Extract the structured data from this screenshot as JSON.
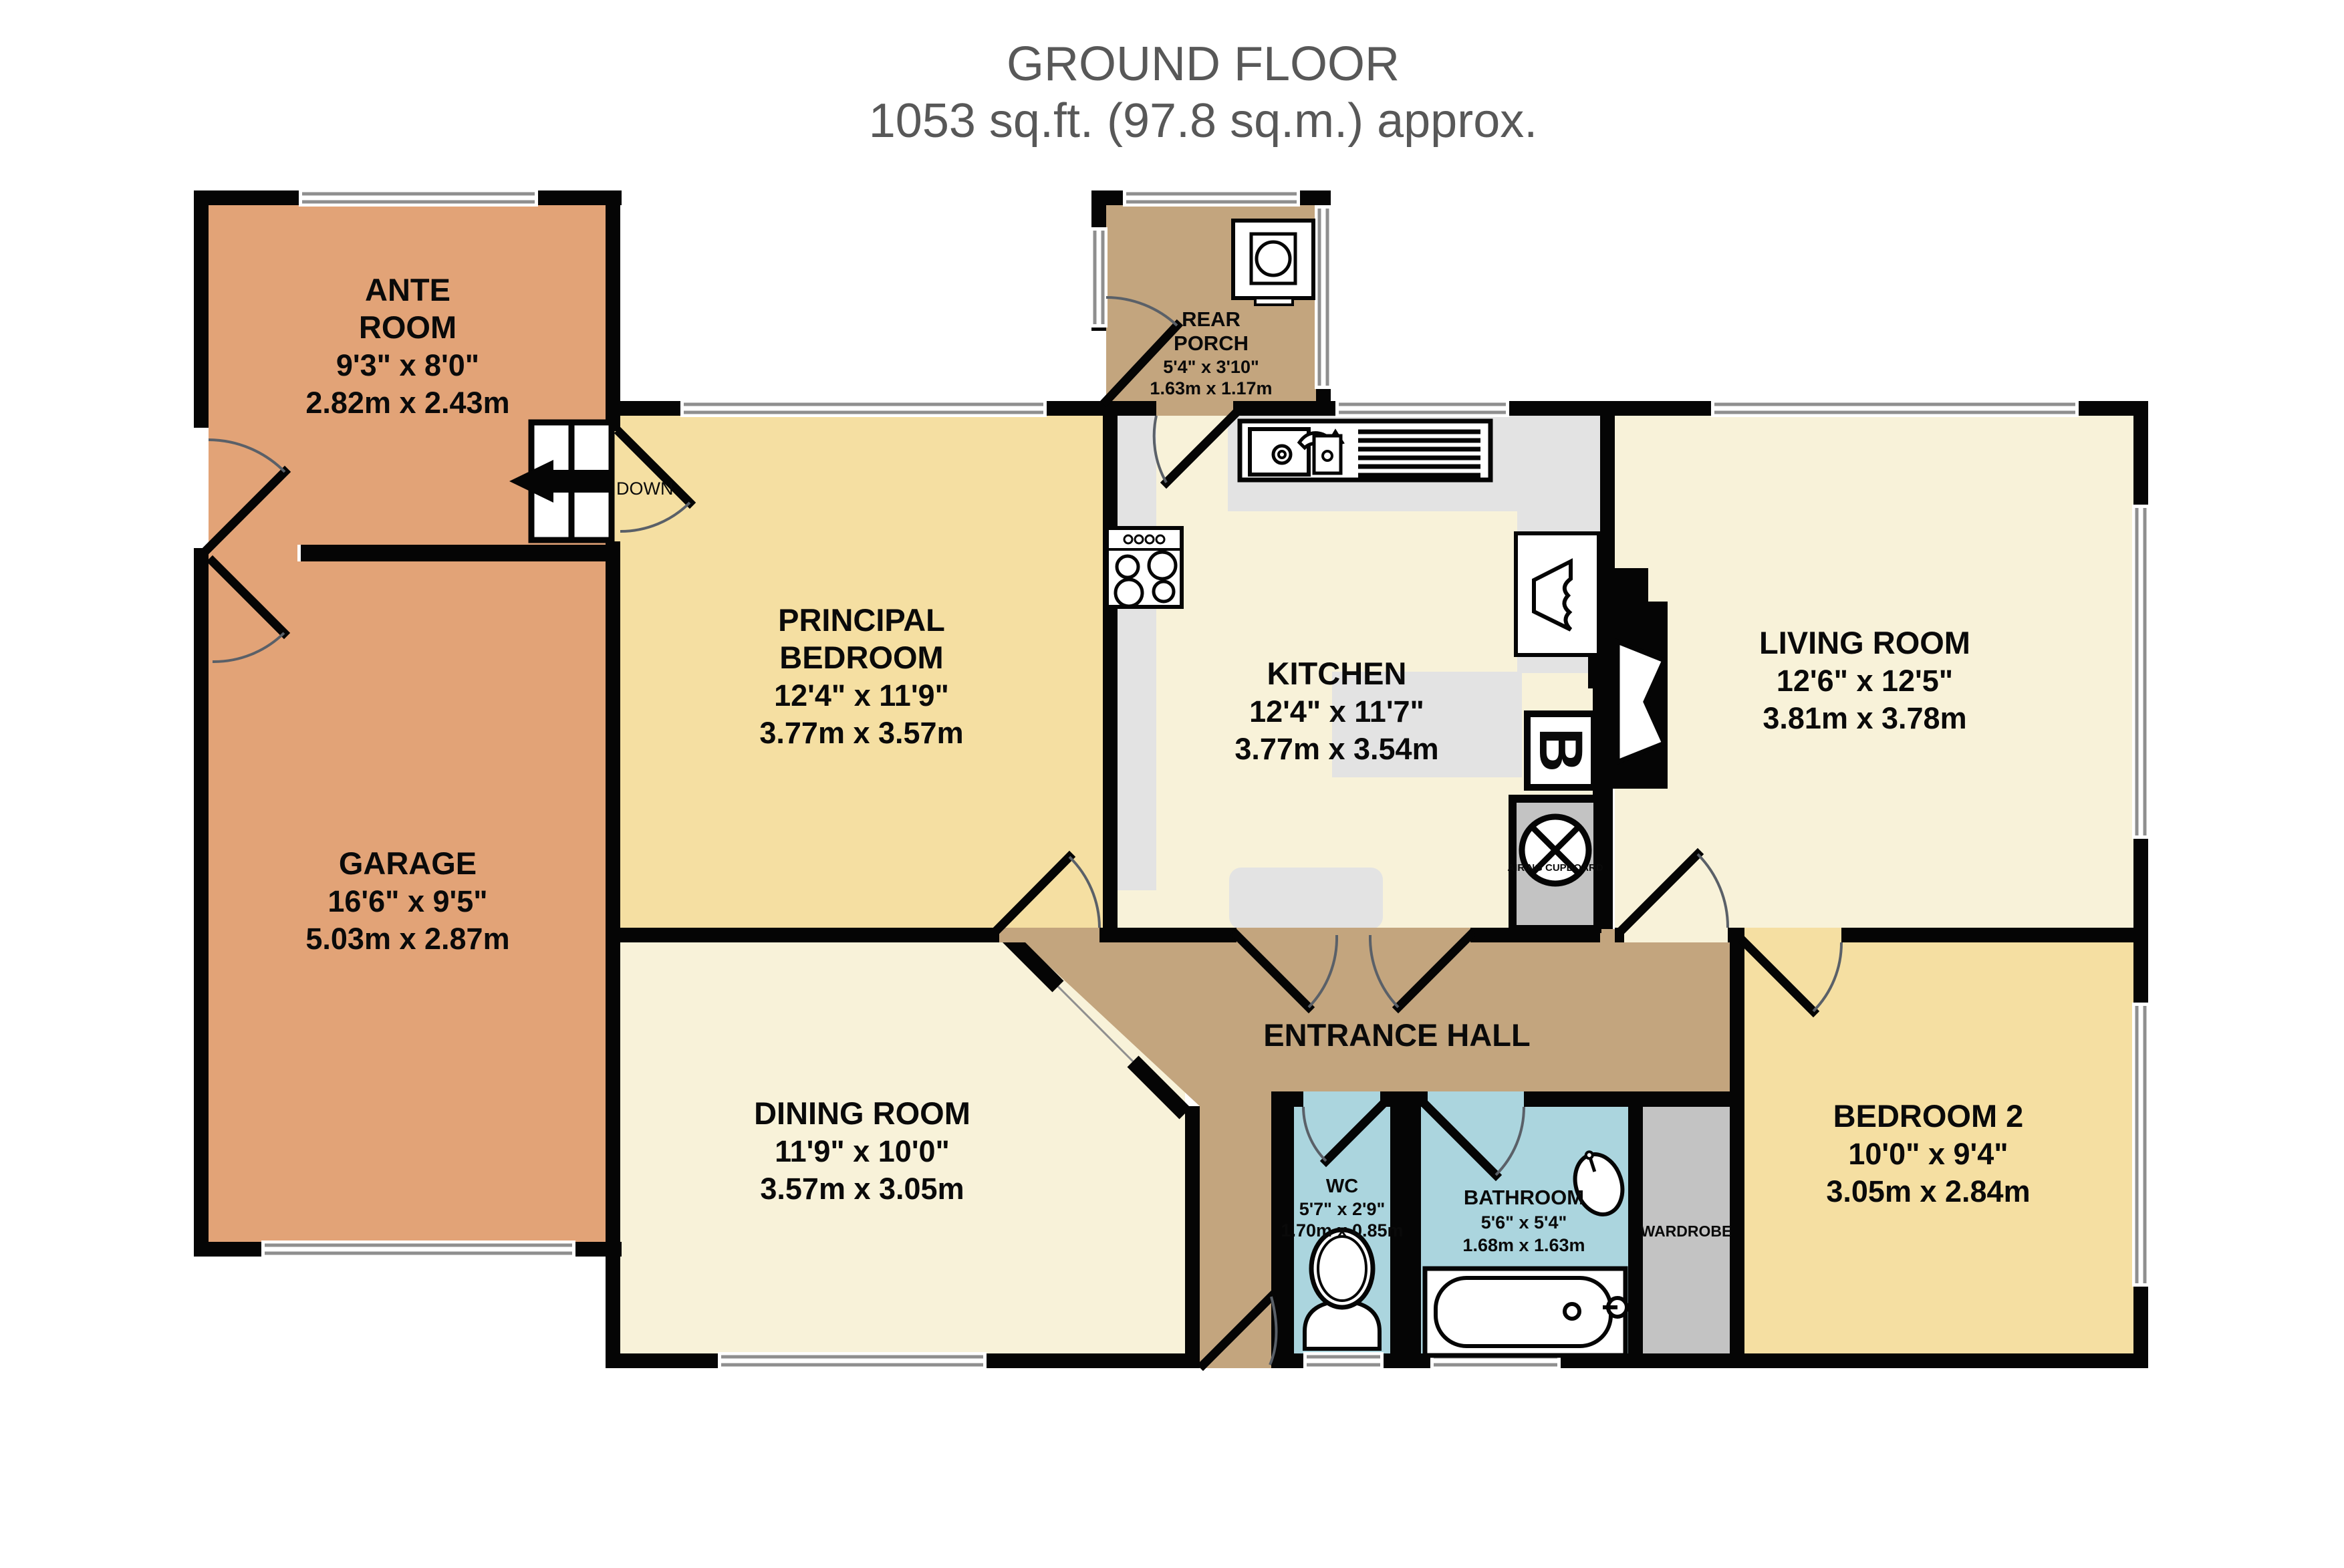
{
  "title": {
    "line1": "GROUND FLOOR",
    "line2": "1053 sq.ft. (97.8 sq.m.) approx."
  },
  "colors": {
    "wall": "#050505",
    "orange": "#e2a377",
    "gold": "#f5dfa2",
    "cream": "#f8f2d9",
    "tan": "#c3a57e",
    "blue": "#abd5de",
    "counter": "#e3e3e3",
    "storage": "#c3c3c3",
    "window_line": "#8f8f8f",
    "door_arc": "#5a6068",
    "title": "#585858",
    "text": "#0a0a0a"
  },
  "rooms": {
    "ante_room": {
      "l1": "ANTE",
      "l2": "ROOM",
      "imp": "9'3\"  x 8'0\"",
      "met": "2.82m  x 2.43m"
    },
    "garage": {
      "l1": "GARAGE",
      "imp": "16'6\"  x 9'5\"",
      "met": "5.03m  x 2.87m"
    },
    "principal_bedroom": {
      "l1": "PRINCIPAL",
      "l2": "BEDROOM",
      "imp": "12'4\"  x 11'9\"",
      "met": "3.77m  x 3.57m"
    },
    "kitchen": {
      "l1": "KITCHEN",
      "imp": "12'4\"  x 11'7\"",
      "met": "3.77m  x 3.54m"
    },
    "living_room": {
      "l1": "LIVING ROOM",
      "imp": "12'6\"  x 12'5\"",
      "met": "3.81m  x 3.78m"
    },
    "dining_room": {
      "l1": "DINING ROOM",
      "imp": "11'9\"  x 10'0\"",
      "met": "3.57m  x 3.05m"
    },
    "bedroom_2": {
      "l1": "BEDROOM 2",
      "imp": "10'0\"  x 9'4\"",
      "met": "3.05m  x 2.84m"
    },
    "rear_porch": {
      "l1": "REAR",
      "l2": "PORCH",
      "imp": "5'4\"  x 3'10\"",
      "met": "1.63m  x 1.17m"
    },
    "wc": {
      "l1": "WC",
      "imp": "5'7\"  x 2'9\"",
      "met": "1.70m  x 0.85m"
    },
    "bathroom": {
      "l1": "BATHROOM",
      "imp": "5'6\"  x 5'4\"",
      "met": "1.68m  x 1.63m"
    },
    "entrance_hall": {
      "l1": "ENTRANCE HALL"
    },
    "wardrobe": {
      "l1": "WARDROBE"
    },
    "airing_cupboard": {
      "l1": "AIRING CUPBOARD"
    }
  },
  "labels": {
    "down": "DOWN",
    "boiler": "B"
  }
}
